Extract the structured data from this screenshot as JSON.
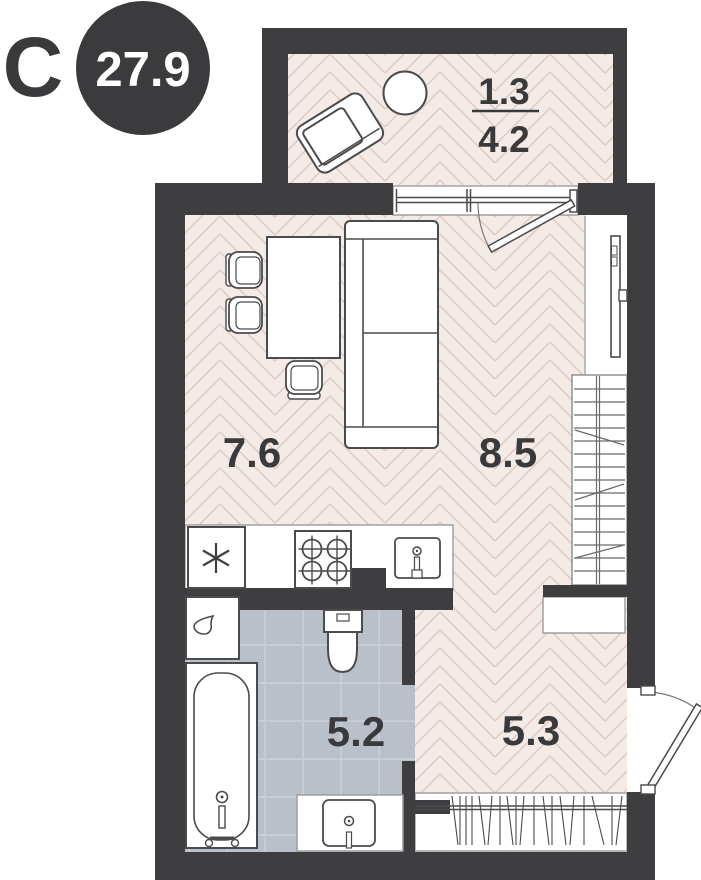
{
  "plan": {
    "north_label": "С",
    "total_area": "27.9",
    "rooms": {
      "balcony": {
        "living_area": "1.3",
        "total_area": "4.2"
      },
      "kitchen": {
        "area": "7.6"
      },
      "living_room": {
        "area": "8.5"
      },
      "bathroom": {
        "area": "5.2"
      },
      "hallway": {
        "area": "5.3"
      }
    },
    "colors": {
      "wall": "#3e3e40",
      "floor": "#f5ebe6",
      "floor_line": "#ddcbc4",
      "tile": "#b9c0ca",
      "tile_line": "#c9cfd8",
      "badge": "#3b3b3d",
      "label_text": "#3a3a3c"
    },
    "icons": {
      "fridge": "snowflake-icon",
      "washing_machine": "water-drop-icon"
    }
  }
}
